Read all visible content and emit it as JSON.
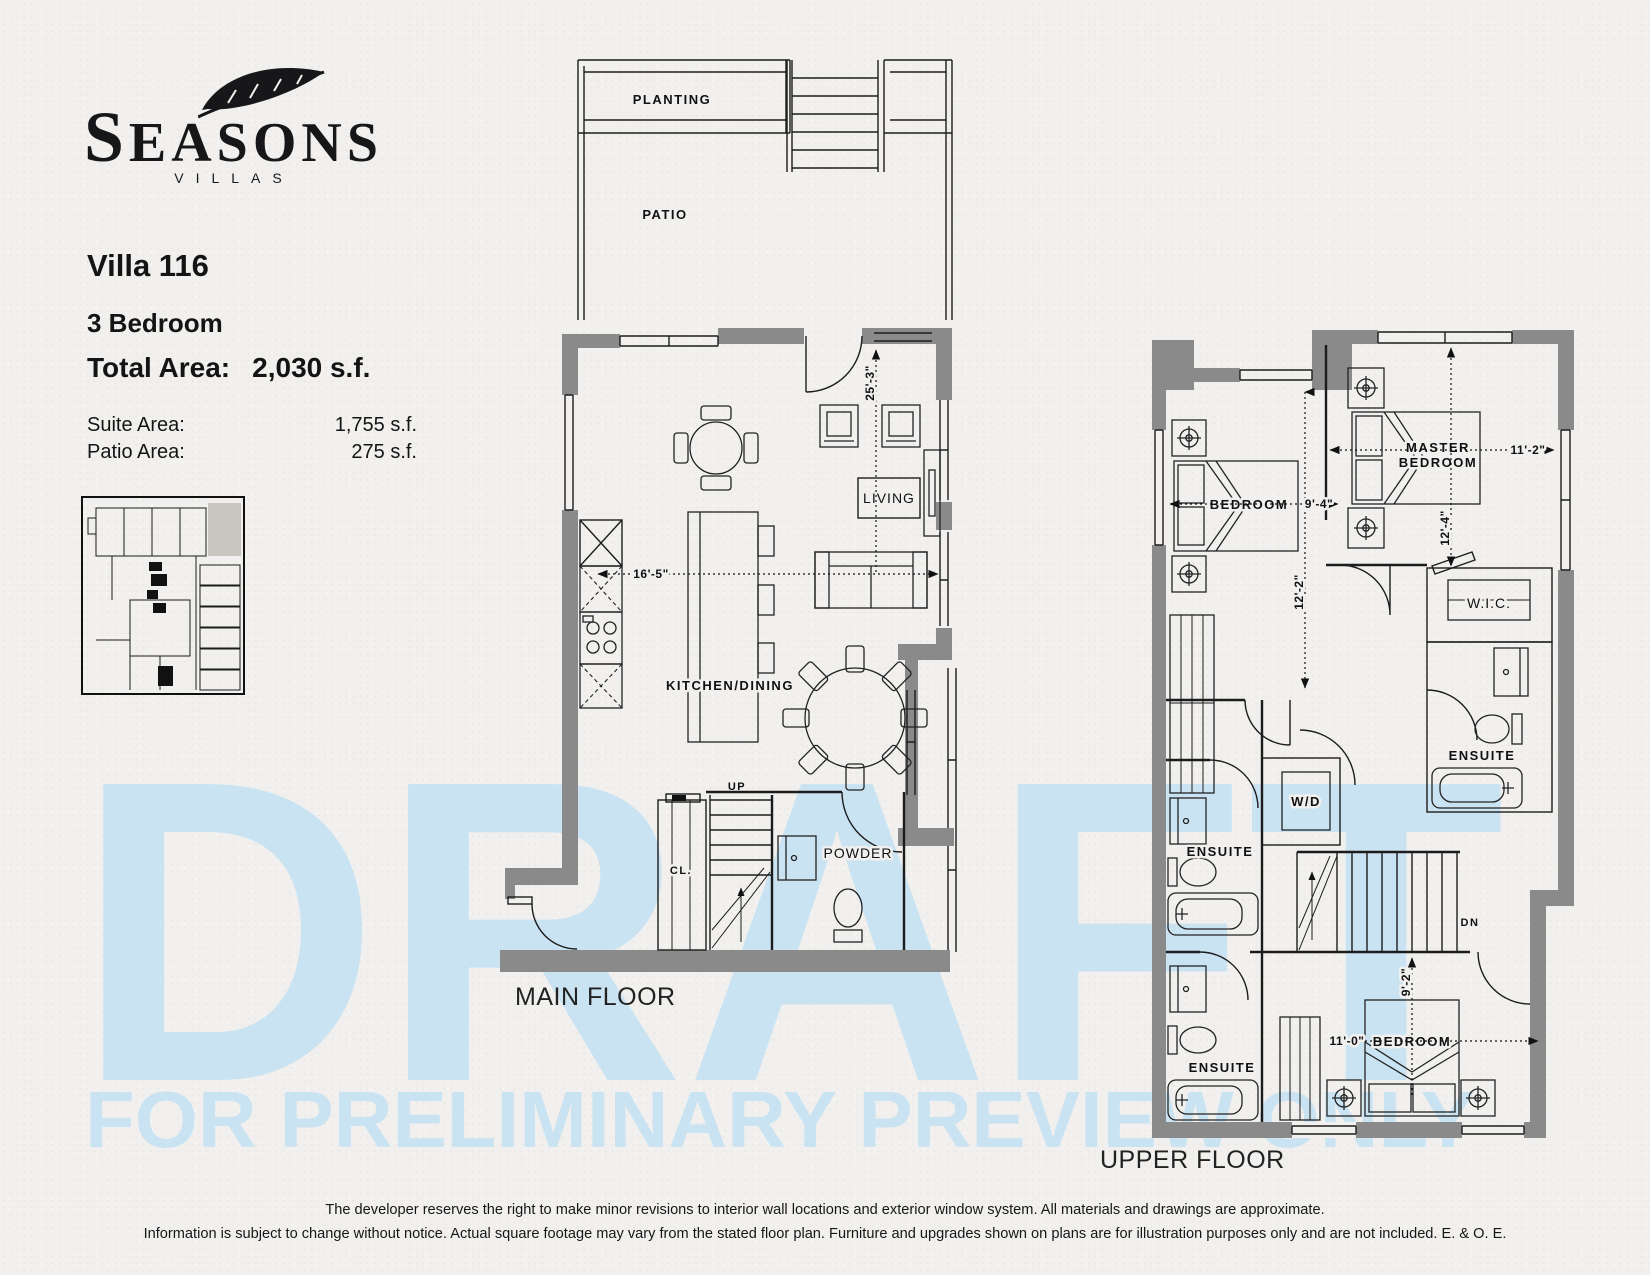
{
  "brand": {
    "name": "SEASONS",
    "tagline": "VILLAS"
  },
  "title_block": {
    "villa": "Villa 116",
    "bedrooms": "3 Bedroom",
    "total_label": "Total Area:",
    "total_value": "2,030 s.f.",
    "areas": [
      {
        "label": "Suite Area:",
        "value": "1,755 s.f."
      },
      {
        "label": "Patio Area:",
        "value": "275 s.f."
      }
    ]
  },
  "main_floor": {
    "title": "MAIN FLOOR",
    "planting": "PLANTING",
    "patio": "PATIO",
    "living": "LIVING",
    "kitchen_dining": "KITCHEN/DINING",
    "up": "UP",
    "closet": "CL.",
    "powder": "POWDER",
    "dim_width": "16'-5\"",
    "dim_height": "25'-3\""
  },
  "upper_floor": {
    "title": "UPPER FLOOR",
    "bedroom_left": "BEDROOM",
    "bedroom_left_width": "9'-4\"",
    "bedroom_left_height": "12'-2\"",
    "master_line1": "MASTER",
    "master_line2": "BEDROOM",
    "master_width": "11'-2\"",
    "master_height": "12'-4\"",
    "wic": "W.I.C.",
    "ensuite_master": "ENSUITE",
    "ensuite_middle": "ENSUITE",
    "ensuite_bottom": "ENSUITE",
    "wd": "W/D",
    "dn": "DN",
    "bedroom_bottom": "BEDROOM",
    "bedroom_bottom_width": "11'-0\"",
    "bedroom_bottom_height": "9'-2\""
  },
  "watermark": {
    "line1": "DRAFT",
    "line2": "FOR PRELIMINARY PREVIEW ONLY"
  },
  "disclaimer": {
    "line1": "The developer reserves the right to make minor revisions to interior wall locations and exterior window system. All materials and drawings are approximate.",
    "line2": "Information is subject to change without notice. Actual square footage may vary from the stated floor plan. Furniture and upgrades shown on plans are for illustration purposes only and are not included. E. & O. E."
  },
  "colors": {
    "paper": "#f1f0ee",
    "wall": "#8a8a8a",
    "line": "#1c1c1c",
    "watermark": "#cae3f2"
  }
}
